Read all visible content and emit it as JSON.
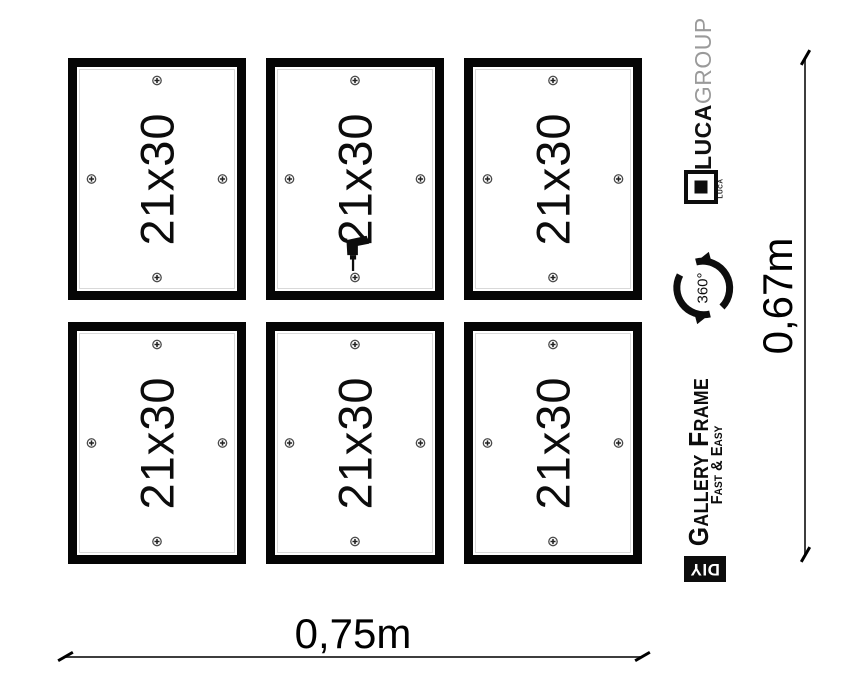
{
  "window": {
    "width": 856,
    "height": 697
  },
  "frames": {
    "label": "21x30",
    "count": 6,
    "rows": 2,
    "cols": 3,
    "screws_per_frame": 4,
    "screw_positions": [
      "top",
      "right",
      "bottom",
      "left"
    ],
    "drill_frame_index": 1
  },
  "dimensions": {
    "width_label": "0,75m",
    "height_label": "0,67m"
  },
  "branding": {
    "company_name_bold": "LUCA",
    "company_name_light": "GROUP",
    "logo_small_text": "LUCA",
    "rotation_badge": "360°",
    "product_title": "Gallery Frame",
    "product_subtitle": "Fast & Easy",
    "diy_badge": "DIY"
  },
  "colors": {
    "frame_border": "#050505",
    "text": "#0c0c0c",
    "group_text": "#9a9a9a",
    "dimension_line": "#3d3d3d",
    "diy_background": "#0d0d0d"
  }
}
